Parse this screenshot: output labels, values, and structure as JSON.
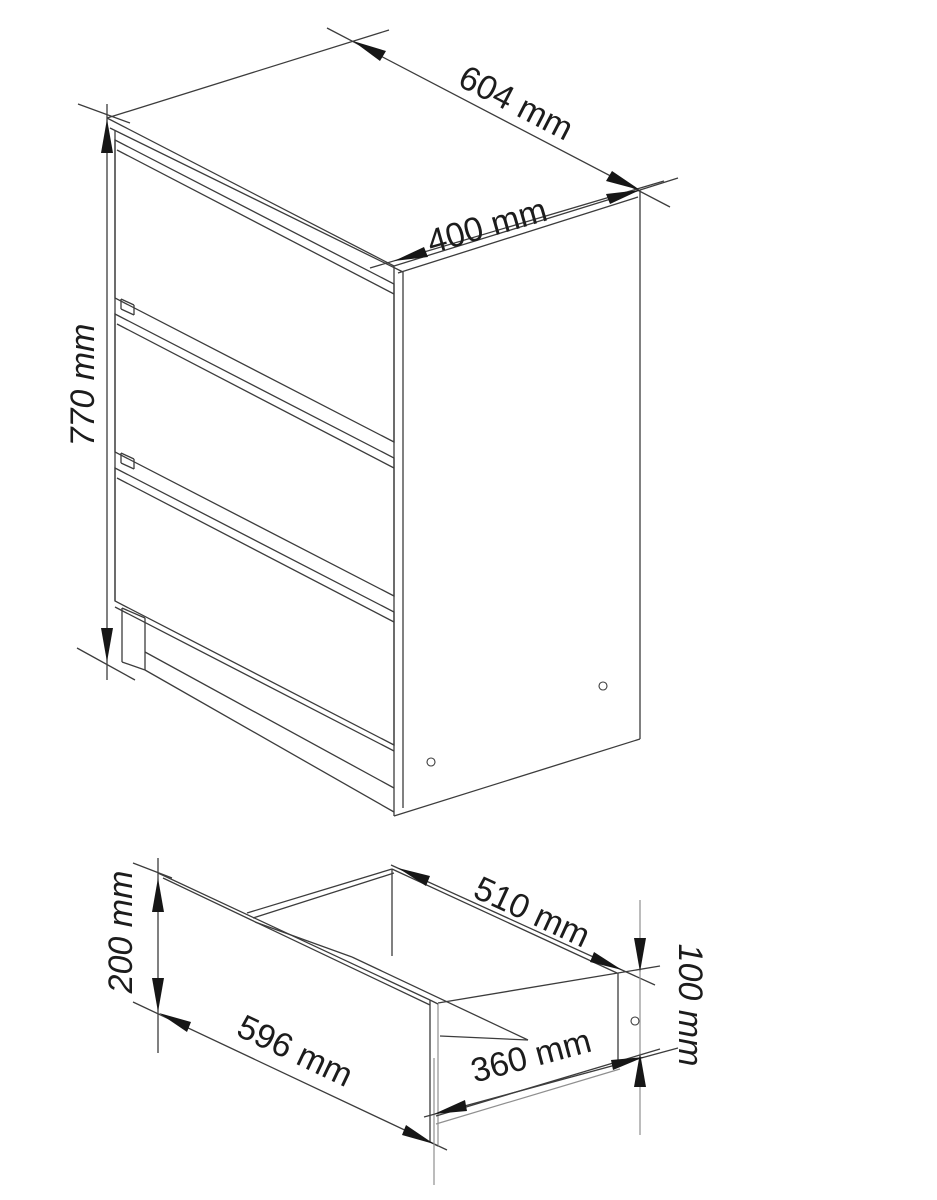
{
  "drawing": {
    "title": "chest-of-drawers-technical-drawing",
    "background_color": "#ffffff",
    "line_color": "#3c3c3c",
    "arrow_color": "#161616",
    "text_color": "#1c1c1c",
    "figures": {
      "cabinet": {
        "name": "three-drawer-cabinet-isometric",
        "drawer_count": 3,
        "dims": {
          "width": "604 mm",
          "depth": "400 mm",
          "height": "770 mm"
        }
      },
      "drawer": {
        "name": "single-drawer-isometric",
        "dims": {
          "front_width": "596 mm",
          "front_height": "200 mm",
          "inner_width": "510 mm",
          "depth": "360 mm",
          "side_height": "100 mm"
        }
      }
    }
  }
}
